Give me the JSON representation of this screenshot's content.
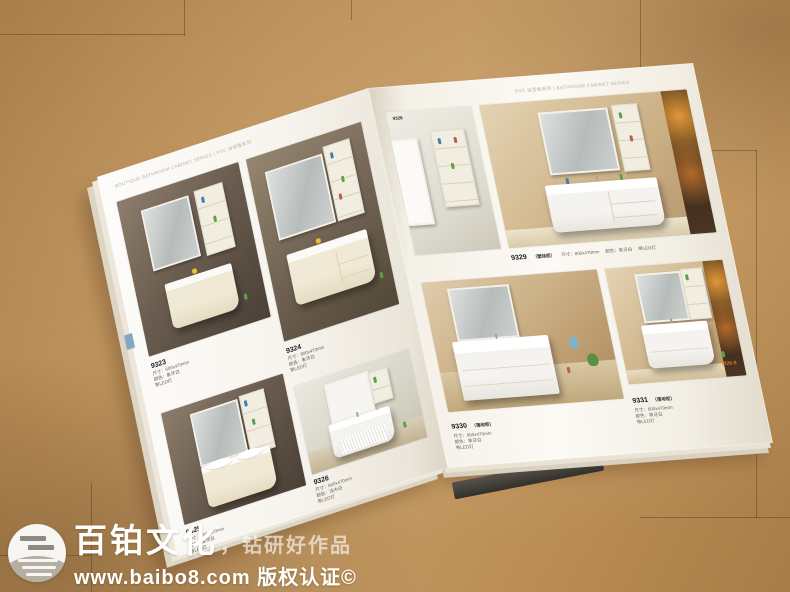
{
  "watermark": {
    "brand": "百铂文化",
    "tagline": "，钻研好作品",
    "url_line": "www.baibo8.com 版权认证©"
  },
  "left_page": {
    "header": "BOUTIQUE BATHROOM CABINET SERIES | PVC 浴室柜系列",
    "products": [
      {
        "model": "9323",
        "line1": "尺寸：600x470mm",
        "line2": "颜色：象牙白",
        "line3": "带LED灯"
      },
      {
        "model": "9324",
        "line1": "尺寸：800x470mm",
        "line2": "颜色：象牙白",
        "line3": "带LED灯"
      },
      {
        "model": "9325",
        "line1": "尺寸：700x470mm",
        "line2": "颜色：象牙白",
        "line3": "带LED灯"
      },
      {
        "model": "9326",
        "line1": "尺寸：600x470mm",
        "line2": "颜色：浅木白",
        "line3": "带LED灯"
      }
    ]
  },
  "right_page": {
    "header": "PVC 浴室柜系列 | BATHROOM CABINET SERIES",
    "page_marker": "W26-8",
    "products": [
      {
        "model": "9328"
      },
      {
        "model": "9329",
        "variant": "（壁挂柜）",
        "line1": "尺寸：800x470mm",
        "line2": "颜色：象牙白",
        "line3": "带LED灯"
      },
      {
        "model": "9330",
        "variant": "（落地柜）",
        "line1": "尺寸：800x470mm",
        "line2": "颜色：象牙白",
        "line3": "带LED灯"
      },
      {
        "model": "9331",
        "variant": "（落地柜）",
        "line1": "尺寸：600x470mm",
        "line2": "颜色：象牙白",
        "line3": "带LED灯"
      }
    ]
  }
}
